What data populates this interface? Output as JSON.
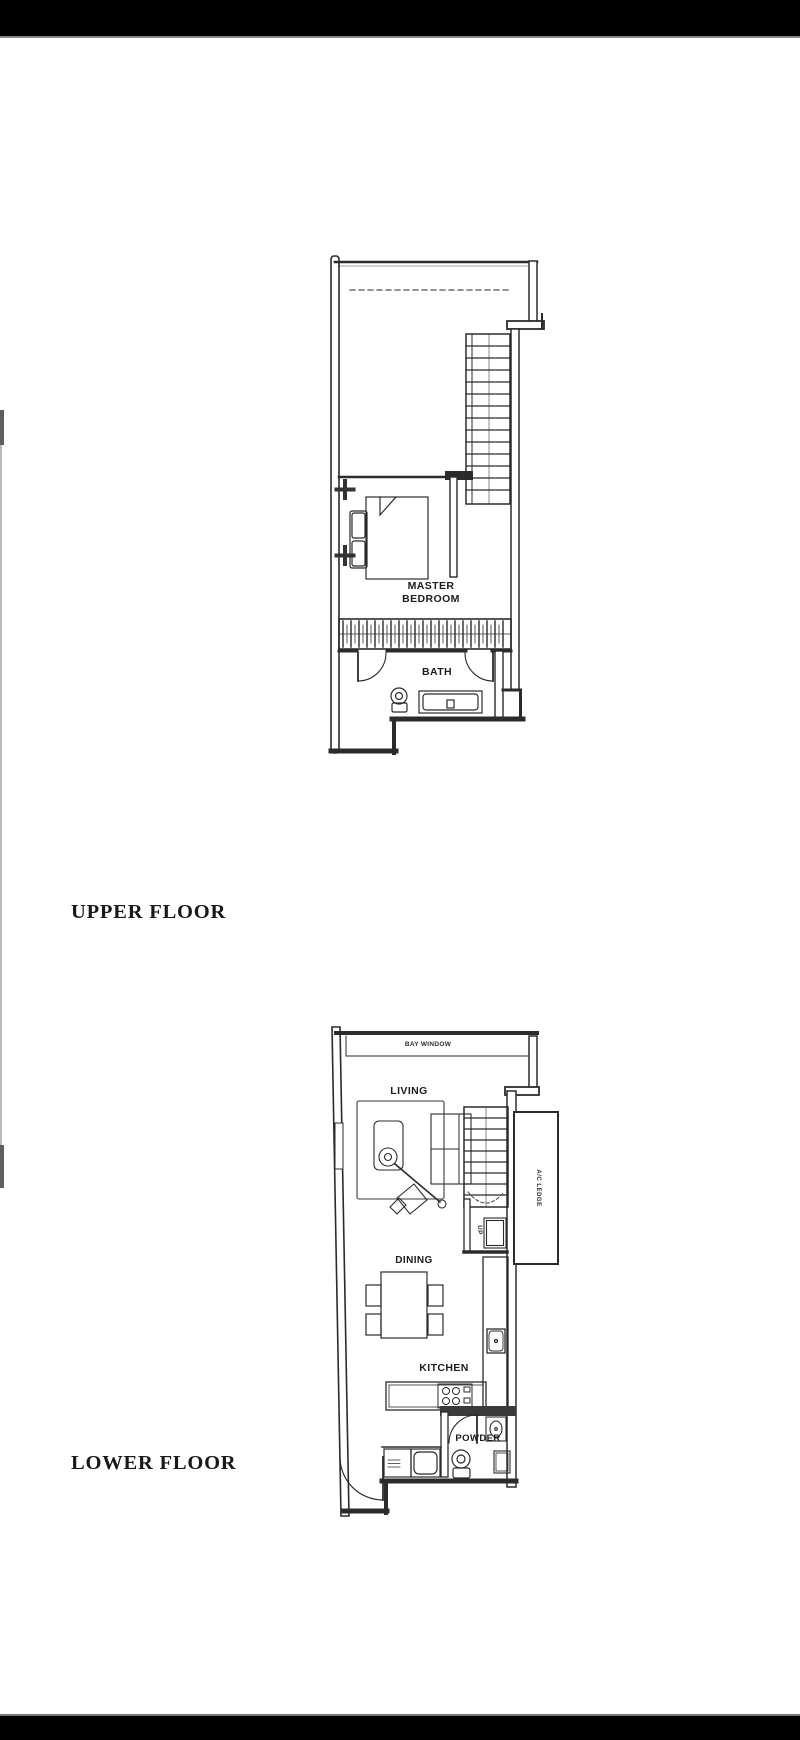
{
  "colors": {
    "background": "#ffffff",
    "letterbox_bar": "#000000",
    "plan_line": "#2b2b2b",
    "label_text": "#1c1c1c"
  },
  "sections": {
    "upper": {
      "label": "UPPER FLOOR"
    },
    "lower": {
      "label": "LOWER FLOOR"
    }
  },
  "upper_plan": {
    "rooms": {
      "master_bedroom": "MASTER BEDROOM",
      "bath": "BATH"
    }
  },
  "lower_plan": {
    "rooms": {
      "living": "LIVING",
      "dining": "DINING",
      "kitchen": "KITCHEN",
      "powder": "POWDER"
    },
    "annotations": {
      "bay_window": "BAY WINDOW",
      "ac_ledge": "A/C LEDGE",
      "stair_direction": "UP"
    }
  }
}
